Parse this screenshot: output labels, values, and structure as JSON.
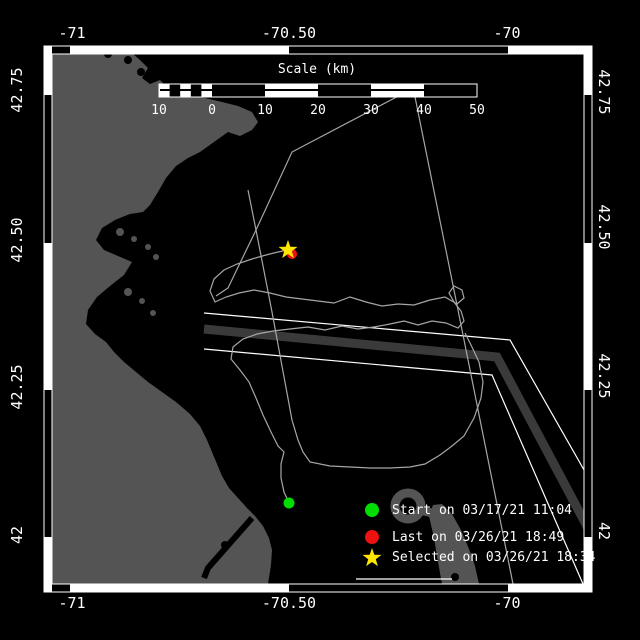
{
  "title": "Drifter track map",
  "colors": {
    "background": "#000000",
    "land": "#545454",
    "lane": "#3a3a3a",
    "track": "#a6a6a6",
    "frame": "#ffffff",
    "text": "#ffffff",
    "start": "#00dd00",
    "last": "#ee1111",
    "selected": "#ffe600"
  },
  "axes": {
    "top": [
      {
        "label": "-71",
        "x": 72
      },
      {
        "label": "-70.50",
        "x": 289
      },
      {
        "label": "-70",
        "x": 507
      }
    ],
    "bottom": [
      {
        "label": "-71",
        "x": 72
      },
      {
        "label": "-70.50",
        "x": 289
      },
      {
        "label": "-70",
        "x": 507
      }
    ],
    "left": [
      {
        "label": "42.75",
        "y": 90
      },
      {
        "label": "42.50",
        "y": 240
      },
      {
        "label": "42.25",
        "y": 387
      },
      {
        "label": "42",
        "y": 535
      }
    ],
    "right": [
      {
        "label": "42.75",
        "y": 92
      },
      {
        "label": "42.50",
        "y": 227
      },
      {
        "label": "42.25",
        "y": 376
      },
      {
        "label": "42",
        "y": 531
      }
    ]
  },
  "scalebar": {
    "title": "Scale (km)",
    "title_x": 317,
    "title_y": 62,
    "bar": {
      "x": 159,
      "y": 84,
      "w": 318,
      "h": 13,
      "fine_end": 212
    },
    "ticks": [
      {
        "label": "10",
        "x": 159
      },
      {
        "label": "0",
        "x": 212
      },
      {
        "label": "10",
        "x": 265
      },
      {
        "label": "20",
        "x": 318
      },
      {
        "label": "30",
        "x": 371
      },
      {
        "label": "40",
        "x": 424
      },
      {
        "label": "50",
        "x": 477
      }
    ],
    "tick_y": 103
  },
  "legend": {
    "marker_x": 372,
    "label_x": 392,
    "items": [
      {
        "marker": "circle",
        "color": "start",
        "y": 510,
        "label": "Start on 03/17/21 11:04"
      },
      {
        "marker": "circle",
        "color": "last",
        "y": 537,
        "label": "Last on 03/26/21 18:49"
      },
      {
        "marker": "star",
        "color": "selected",
        "y": 557,
        "label": "Selected on 03/26/21 18:34"
      }
    ]
  },
  "markers": {
    "start": {
      "x": 289,
      "y": 503,
      "r": 5.5
    },
    "last": {
      "x": 292,
      "y": 254,
      "r": 5
    },
    "selected": {
      "x": 288,
      "y": 250,
      "R": 10,
      "r": 4
    }
  },
  "map_geometry": {
    "clip": [
      52,
      54,
      532,
      531
    ],
    "land_polygons": [
      {
        "name": "mainland",
        "points": [
          [
            52,
            54
          ],
          [
            133,
            54
          ],
          [
            140,
            60
          ],
          [
            148,
            68
          ],
          [
            142,
            78
          ],
          [
            150,
            84
          ],
          [
            160,
            80
          ],
          [
            168,
            88
          ],
          [
            178,
            92
          ],
          [
            190,
            96
          ],
          [
            205,
            98
          ],
          [
            222,
            102
          ],
          [
            238,
            106
          ],
          [
            252,
            112
          ],
          [
            258,
            122
          ],
          [
            252,
            130
          ],
          [
            240,
            136
          ],
          [
            228,
            132
          ],
          [
            214,
            142
          ],
          [
            200,
            152
          ],
          [
            188,
            158
          ],
          [
            176,
            166
          ],
          [
            166,
            178
          ],
          [
            158,
            192
          ],
          [
            150,
            205
          ],
          [
            143,
            212
          ],
          [
            130,
            214
          ],
          [
            115,
            220
          ],
          [
            102,
            228
          ],
          [
            96,
            240
          ],
          [
            104,
            250
          ],
          [
            118,
            256
          ],
          [
            132,
            262
          ],
          [
            124,
            275
          ],
          [
            110,
            286
          ],
          [
            97,
            297
          ],
          [
            88,
            310
          ],
          [
            86,
            324
          ],
          [
            95,
            334
          ],
          [
            106,
            342
          ],
          [
            114,
            352
          ],
          [
            124,
            362
          ],
          [
            136,
            372
          ],
          [
            148,
            382
          ],
          [
            162,
            392
          ],
          [
            176,
            402
          ],
          [
            190,
            414
          ],
          [
            200,
            426
          ],
          [
            207,
            440
          ],
          [
            212,
            452
          ],
          [
            217,
            464
          ],
          [
            222,
            476
          ],
          [
            229,
            488
          ],
          [
            238,
            498
          ],
          [
            247,
            508
          ],
          [
            255,
            516
          ],
          [
            263,
            526
          ],
          [
            269,
            538
          ],
          [
            272,
            550
          ],
          [
            271,
            565
          ],
          [
            268,
            584
          ],
          [
            52,
            584
          ]
        ]
      },
      {
        "name": "cape-cod-forearm",
        "points": [
          [
            442,
            584
          ],
          [
            438,
            562
          ],
          [
            434,
            538
          ],
          [
            429,
            516
          ],
          [
            433,
            505
          ],
          [
            442,
            504
          ],
          [
            452,
            514
          ],
          [
            461,
            530
          ],
          [
            469,
            549
          ],
          [
            475,
            566
          ],
          [
            479,
            584
          ]
        ]
      }
    ],
    "land_circles": [
      {
        "name": "harbor-island",
        "cx": 120,
        "cy": 232,
        "r": 4
      },
      {
        "name": "harbor-island",
        "cx": 134,
        "cy": 239,
        "r": 3
      },
      {
        "name": "harbor-island",
        "cx": 148,
        "cy": 247,
        "r": 3
      },
      {
        "name": "harbor-island",
        "cx": 156,
        "cy": 257,
        "r": 3
      },
      {
        "name": "harbor-island",
        "cx": 108,
        "cy": 268,
        "r": 3
      },
      {
        "name": "harbor-island",
        "cx": 128,
        "cy": 292,
        "r": 4
      },
      {
        "name": "harbor-island",
        "cx": 142,
        "cy": 301,
        "r": 3
      },
      {
        "name": "harbor-island",
        "cx": 153,
        "cy": 313,
        "r": 3
      }
    ],
    "provincetown_curl": {
      "cx": 408,
      "cy": 506,
      "r": 13,
      "stroke_w": 9
    },
    "curl_stub": [
      [
        420,
        510
      ],
      [
        432,
        513
      ]
    ],
    "black_details": {
      "canal": {
        "points": [
          [
            252,
            518
          ],
          [
            208,
            568
          ],
          [
            204,
            578
          ]
        ],
        "w": 6
      },
      "blobs": [
        {
          "cx": 128,
          "cy": 60,
          "r": 4
        },
        {
          "cx": 141,
          "cy": 72,
          "r": 4
        },
        {
          "cx": 108,
          "cy": 54,
          "r": 4
        },
        {
          "cx": 152,
          "cy": 64,
          "r": 3
        },
        {
          "cx": 225,
          "cy": 545,
          "r": 4
        },
        {
          "cx": 455,
          "cy": 577,
          "r": 4
        }
      ]
    },
    "shipping_lane": {
      "band": {
        "points": [
          [
            204,
            329
          ],
          [
            497,
            357
          ],
          [
            590,
            532
          ]
        ],
        "w": 9
      },
      "boundary_upper": [
        [
          204,
          313
        ],
        [
          510,
          340
        ],
        [
          592,
          484
        ]
      ],
      "boundary_lower": [
        [
          204,
          349
        ],
        [
          492,
          375
        ],
        [
          583,
          584
        ]
      ]
    },
    "shore_line": [
      [
        356,
        579
      ],
      [
        452,
        579
      ]
    ],
    "track_lines": {
      "line_a": [
        [
          408,
          91
        ],
        [
          292,
          152
        ],
        [
          256,
          230
        ],
        [
          228,
          288
        ],
        [
          216,
          296
        ]
      ],
      "line_b": [
        [
          414,
          92
        ],
        [
          458,
          310
        ],
        [
          513,
          584
        ]
      ],
      "line_c": [
        [
          248,
          190
        ],
        [
          256,
          230
        ],
        [
          272,
          312
        ],
        [
          292,
          420
        ],
        [
          298,
          440
        ],
        [
          303,
          452
        ],
        [
          310,
          462
        ],
        [
          330,
          466
        ],
        [
          350,
          467
        ],
        [
          370,
          468
        ],
        [
          390,
          468
        ],
        [
          410,
          467
        ],
        [
          425,
          464
        ],
        [
          440,
          455
        ],
        [
          452,
          446
        ],
        [
          464,
          436
        ],
        [
          474,
          418
        ],
        [
          481,
          398
        ],
        [
          483,
          382
        ],
        [
          479,
          362
        ],
        [
          471,
          345
        ],
        [
          465,
          333
        ]
      ],
      "track_main": [
        [
          289,
          503
        ],
        [
          284,
          492
        ],
        [
          281,
          478
        ],
        [
          281,
          464
        ],
        [
          284,
          452
        ],
        [
          278,
          446
        ],
        [
          271,
          432
        ],
        [
          263,
          415
        ],
        [
          256,
          398
        ],
        [
          249,
          382
        ],
        [
          240,
          370
        ],
        [
          231,
          359
        ],
        [
          233,
          347
        ],
        [
          243,
          339
        ],
        [
          257,
          334
        ],
        [
          273,
          331
        ],
        [
          290,
          329
        ],
        [
          308,
          327
        ],
        [
          325,
          330
        ],
        [
          342,
          326
        ],
        [
          358,
          329
        ],
        [
          374,
          327
        ],
        [
          390,
          324
        ],
        [
          404,
          321
        ],
        [
          418,
          325
        ],
        [
          432,
          321
        ],
        [
          446,
          323
        ],
        [
          458,
          328
        ],
        [
          464,
          321
        ],
        [
          461,
          311
        ],
        [
          454,
          302
        ],
        [
          449,
          293
        ],
        [
          454,
          286
        ],
        [
          462,
          290
        ],
        [
          464,
          298
        ],
        [
          457,
          304
        ],
        [
          445,
          297
        ],
        [
          430,
          300
        ],
        [
          414,
          305
        ],
        [
          398,
          304
        ],
        [
          382,
          306
        ],
        [
          366,
          302
        ],
        [
          350,
          297
        ],
        [
          334,
          303
        ],
        [
          318,
          301
        ],
        [
          302,
          299
        ],
        [
          286,
          297
        ],
        [
          270,
          293
        ],
        [
          254,
          290
        ],
        [
          239,
          293
        ],
        [
          226,
          297
        ],
        [
          215,
          302
        ],
        [
          210,
          291
        ],
        [
          214,
          279
        ],
        [
          224,
          270
        ],
        [
          237,
          264
        ],
        [
          252,
          259
        ],
        [
          266,
          255
        ],
        [
          278,
          252
        ],
        [
          288,
          250
        ]
      ]
    },
    "frame": {
      "white_rects": [
        [
          44,
          46,
          548,
          8
        ],
        [
          44,
          584,
          548,
          8
        ],
        [
          44,
          46,
          8,
          546
        ],
        [
          584,
          46,
          8,
          546
        ]
      ],
      "black_rects": [
        [
          52,
          46,
          18,
          8
        ],
        [
          289,
          46,
          219,
          8
        ],
        [
          52,
          584,
          18,
          8
        ],
        [
          289,
          584,
          219,
          8
        ],
        [
          44,
          95,
          8,
          148
        ],
        [
          44,
          390,
          8,
          147
        ],
        [
          584,
          95,
          8,
          148
        ],
        [
          584,
          390,
          8,
          147
        ]
      ],
      "outer": [
        44,
        46,
        548,
        546
      ],
      "inner": [
        52,
        54,
        532,
        530
      ]
    }
  }
}
